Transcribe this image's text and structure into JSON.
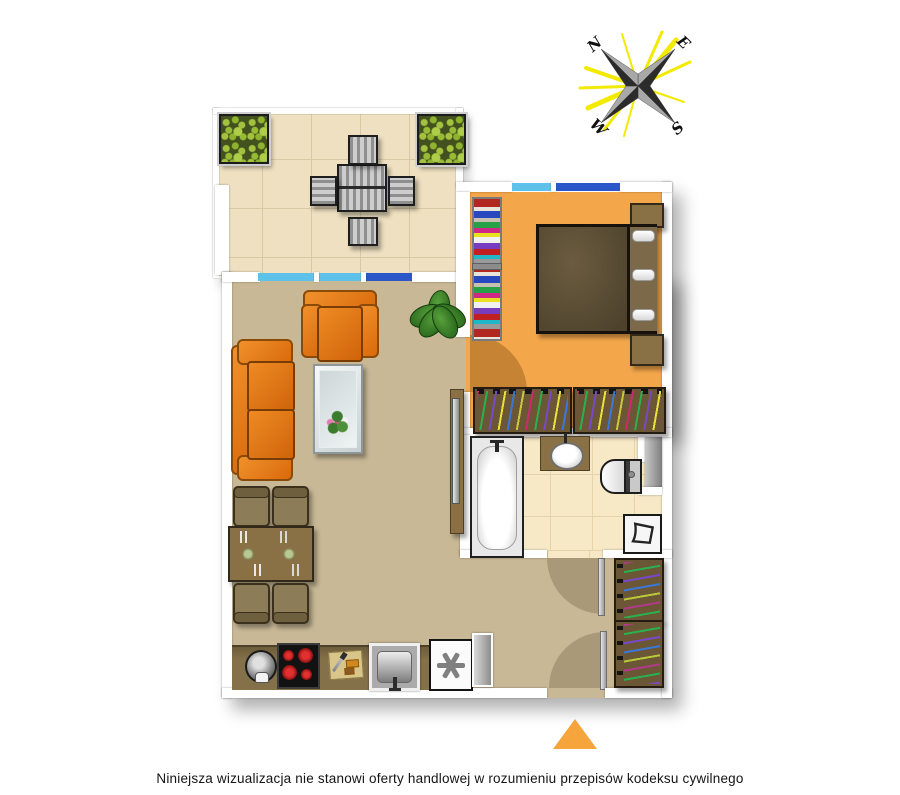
{
  "caption": "Niniejsza wizualizacja nie stanowi oferty handlowej w rozumieniu przepisów kodeksu cywilnego",
  "compass": {
    "north": "N",
    "east": "E",
    "south": "S",
    "west": "W"
  },
  "icons": {
    "compass-rose": "four-point star with yellow rays",
    "entrance-arrow": "▲",
    "fridge-asterisk": "*",
    "laundry-basket": "basket outline"
  },
  "colors": {
    "balcony_floor": "#eee0c0",
    "living_floor": "#c8b896",
    "bedroom_floor": "#f4a74a",
    "bathroom_floor": "#f7e8c6",
    "window_glass_light": "#5ec1ea",
    "window_glass_dark": "#2b57c8",
    "sofa_orange": "#e2720f",
    "wood_brown": "#8a7045",
    "kitchen_counter": "#857149",
    "entrance_marker": "#f6a53c",
    "compass_rays": "#f2ea00",
    "wall": "#ffffff"
  },
  "scene": {
    "balcony": [
      "planter",
      "planter",
      "patio-table",
      "patio-chair x4"
    ],
    "living_room": [
      "sofa",
      "armchair",
      "coffee-table with bouquet",
      "plant",
      "tv-console",
      "dining-table",
      "dining-chair x4"
    ],
    "kitchen": [
      "kettle",
      "cooktop",
      "cutting-board",
      "sink",
      "fridge"
    ],
    "bedroom": [
      "bookshelf",
      "double-bed with 3 pillows",
      "nightstand x2",
      "wardrobe x2",
      "window"
    ],
    "bathroom": [
      "bathtub",
      "washbasin",
      "toilet",
      "laundry-basket",
      "shaft"
    ],
    "hallway": [
      "wardrobe x2",
      "radiator",
      "entrance-door"
    ]
  }
}
